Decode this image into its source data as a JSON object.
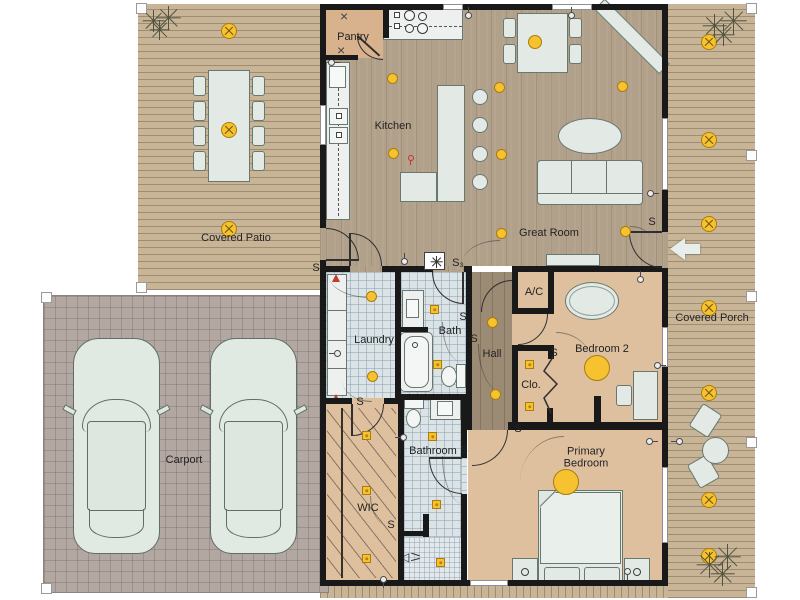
{
  "rooms": {
    "pantry": "Pantry",
    "kitchen": "Kitchen",
    "great_room": "Great Room",
    "covered_patio": "Covered Patio",
    "covered_porch": "Covered Porch",
    "laundry": "Laundry",
    "bath": "Bath",
    "hall": "Hall",
    "ac": "A/C",
    "closet": "Clo.",
    "bedroom2": "Bedroom 2",
    "carport": "Carport",
    "wic": "WIC",
    "bathroom": "Bathroom",
    "primary_bedroom": "Primary Bedroom"
  },
  "switches": {
    "s": "S",
    "s3": "S₃"
  },
  "icons": {
    "pantry_shelf_mark": "×",
    "shower_head": "◁"
  },
  "palette": {
    "wall": "#191919",
    "deck_wood": "#c8b497",
    "interior_wood": "#b1a08a",
    "room_tan": "#dec09e",
    "tile_blue": "#dbe3e7",
    "carport_gray": "#b3a7a2",
    "furniture": "#e3eae6",
    "light_yellow": "#f6c230",
    "alert_red": "#c23b2e"
  }
}
